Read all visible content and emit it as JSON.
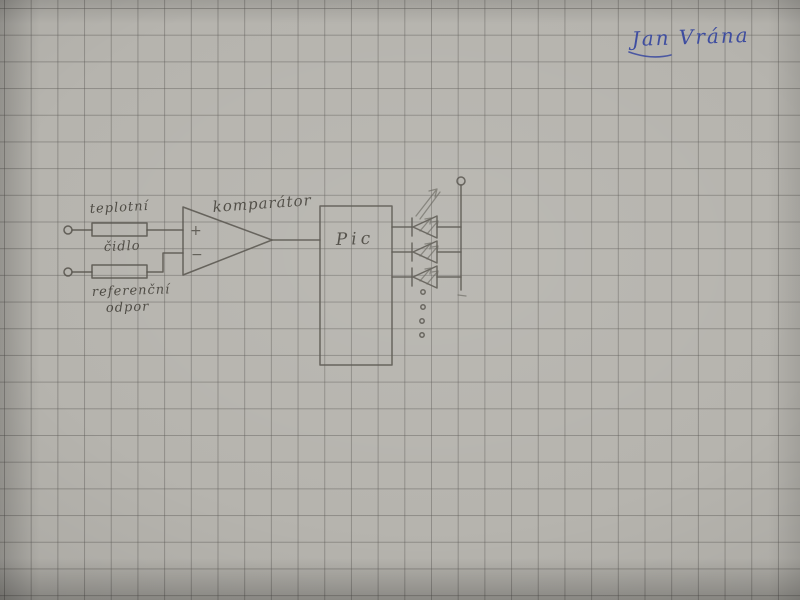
{
  "colors": {
    "paper": "#b6b4ae",
    "grid_line": "#8e8c86",
    "pencil": "#55524b",
    "ink_blue": "#3e4da0"
  },
  "signature": {
    "text": "Jan Vrána"
  },
  "schematic": {
    "sensor": {
      "label_line1": "teplotní",
      "label_line2": "čidlo",
      "symbol": "resistor"
    },
    "reference": {
      "label_line1": "referenční",
      "label_line2": "odpor",
      "symbol": "resistor"
    },
    "comparator": {
      "label": "komparátor",
      "plus": "+",
      "minus": "−"
    },
    "mcu": {
      "label": "Pic"
    },
    "leds": {
      "drawn_count": 3,
      "ellipsis_dot_count": 4
    },
    "terminals": {
      "input_count": 2,
      "supply_count": 1
    }
  }
}
